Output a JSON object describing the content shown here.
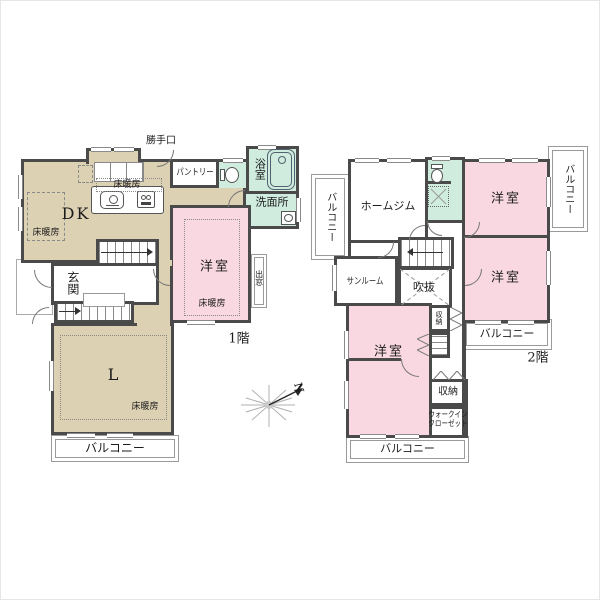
{
  "colors": {
    "wall": "#4a4a4a",
    "floor_tan": "#ddd1b4",
    "room_pink": "#f9d8e2",
    "wet_teal": "#cfecdf",
    "thin_line": "#8a8a8a"
  },
  "floor1": {
    "label": "1階",
    "dk": "DK",
    "living": "L",
    "entrance": "玄関",
    "pantry": "パントリー",
    "bath": "浴室",
    "washroom": "洗面所",
    "western_room": "洋室",
    "bay_window": "出窓",
    "back_door": "勝手口",
    "floor_heating": "床暖房",
    "balcony": "バルコニー"
  },
  "floor2": {
    "label": "2階",
    "home_gym": "ホームジム",
    "sunroom": "サンルーム",
    "void": "吹抜",
    "western_room": "洋室",
    "storage": "収納",
    "walk_in_closet_1": "ウォークイン",
    "walk_in_closet_2": "クローゼット",
    "balcony": "バルコニー"
  },
  "compass": {
    "north": "N"
  }
}
